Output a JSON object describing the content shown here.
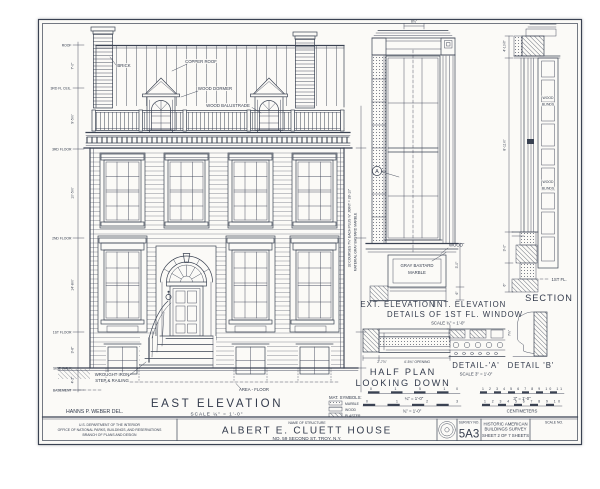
{
  "colors": {
    "ink": "#3a4252",
    "paper": "#fbfaf7"
  },
  "east": {
    "title": "EAST  ELEVATION",
    "scale": "SCALE  ¼\" = 1'-0\"",
    "levels": {
      "roof": "ROOF",
      "ceil3": "3RD FL CEIL.",
      "fl3": "3RD FLOOR",
      "fl2": "2ND FLOOR",
      "fl1": "1ST FLOOR",
      "walk": "SIDE WALK",
      "base": "BASEMENT"
    },
    "dims": {
      "d1": "7'-0\"",
      "d2": "9'-5⅞\"",
      "d3": "10'-5⅞\"",
      "d4": "14'-8⅞\"",
      "d5": "3'-6\"",
      "d6": "4'-2\""
    },
    "ann": {
      "brick": "BRICK",
      "copper": "COPPER  ROOF",
      "dormer": "WOOD DORMER",
      "balustrade": "WOOD  BALUSTRADE",
      "iron1": "WROUGHT IRON",
      "iron2": "STEP & RAILING",
      "area": "AREA - FLOOR",
      "courses": "32 COURSES 7⅜\" EACH PLUS ⅜\" JOINT = 28'-10\"",
      "material": "MATERIAL  GRAY BASTARD MARBLE"
    }
  },
  "detail_win": {
    "cap_ext": "EXT. ELEVATION",
    "cap_int": "INT. ELEVATION",
    "cap_line2": "DETAILS OF 1ST FL. WINDOW",
    "cap_scale": "SCALE  ¾\" = 1'-0\"",
    "marker_a": "A",
    "wood": "WOOD",
    "marble1": "GRAY BASTARD",
    "marble2": "MARBLE",
    "dim_top": "8¾\"",
    "dim_r1": "3'-0\"",
    "dim_r2": "6\""
  },
  "half_plan": {
    "line1": "HALF  PLAN",
    "line2": "LOOKING  DOWN",
    "dim1": "2'-7⅞\"",
    "dim2": "4'-5¾\" OPENING"
  },
  "detail_a": {
    "title": "DETAIL-'A'",
    "scale": "SCALE 3\" = 1'-0\""
  },
  "detail_b": {
    "title": "DETAIL 'B'",
    "dim": "7⅞\""
  },
  "section": {
    "title": "SECTION",
    "blinds1a": "WOOD",
    "blinds1b": "BLINDS",
    "blinds2a": "WOOD",
    "blinds2b": "BLINDS",
    "d1": "4'-10½\"",
    "d2": "8'-11⅞\"",
    "d3": "3'-0\"",
    "d4": "6\"",
    "fl1": "1ST FL."
  },
  "legend": {
    "title": "MAT. SYMBOLS:",
    "marble": "MARBLE",
    "wood": "WOOD",
    "plaster": "PLASTER"
  },
  "bars": {
    "b1_ticks": "0 1 5 10",
    "b1_label": "¼\" = 1'-0\"",
    "b2_ticks": "0 1 2 3",
    "b2_label": "¾\" = 1'-0\"",
    "b3_ticks": "1 2 3 4 5 6 7 8 9 10 11",
    "b3_label": "3\" = 1'-0\"",
    "b4_ticks": "1 2 3 4 5 6 7 8 9 10",
    "b4_label": "CENTIMETERS"
  },
  "block": {
    "del": "HANNS P. WEBER   DEL.",
    "agency1": "U.S. DEPARTMENT OF THE INTERIOR",
    "agency2": "OFFICE OF NATIONAL PARKS, BUILDINGS, AND RESERVATIONS",
    "agency3": "BRANCH OF PLANS AND DESIGN",
    "name_label": "NAME OF STRUCTURE",
    "name": "ALBERT  E. CLUETT  HOUSE",
    "address": "NO. 59 SECOND ST.   TROY,  N.Y.",
    "survey_label": "SURVEY NO.",
    "survey_no": "5A3",
    "habs1": "HISTORIC AMERICAN",
    "habs2": "BUILDINGS SURVEY",
    "habs3": "SHEET 2 OF 7 SHEETS",
    "scale_label": "SCALE NO."
  }
}
